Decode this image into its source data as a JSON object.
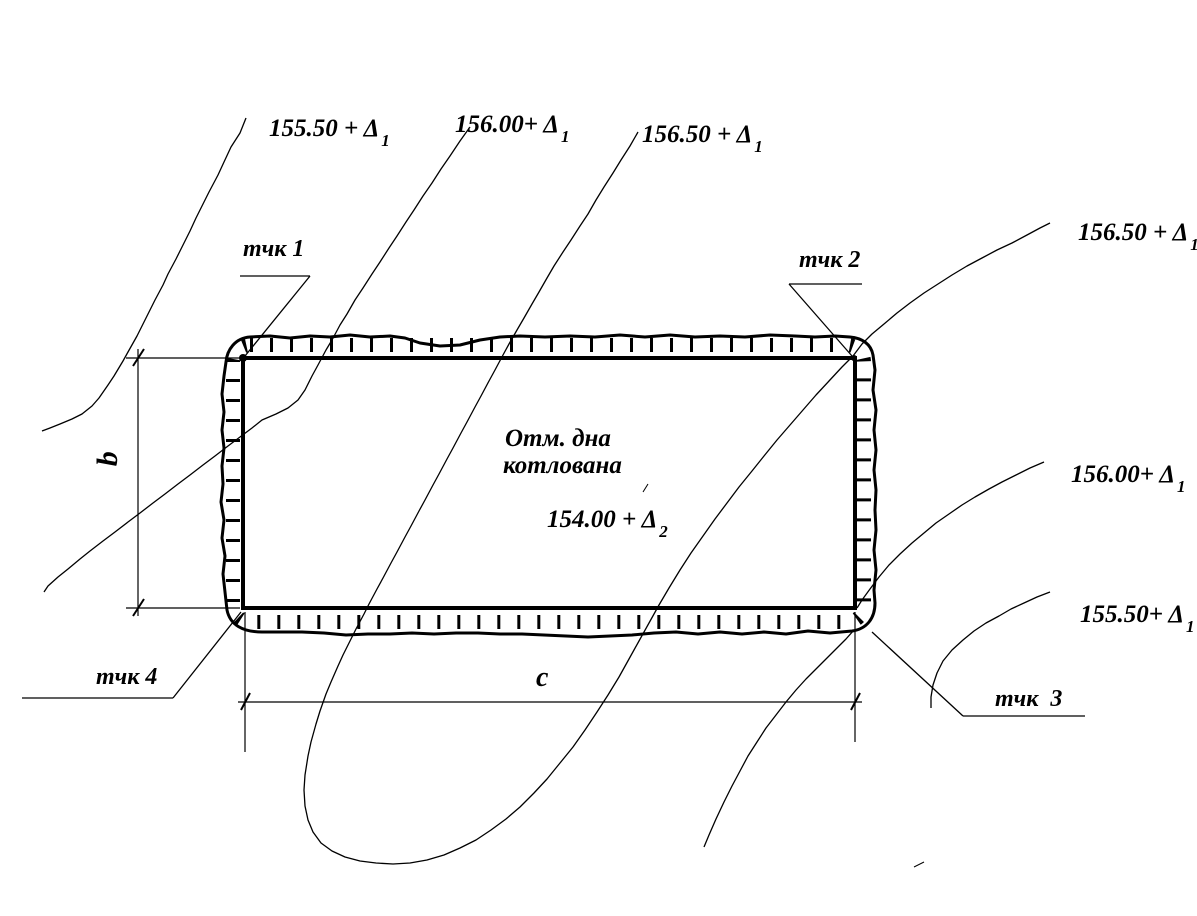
{
  "drawing": {
    "background": "#ffffff",
    "ink": "#000000",
    "contour_labels": {
      "top": [
        {
          "text": "155.50 + Δ",
          "sub": "1"
        },
        {
          "text": "156.00+ Δ",
          "sub": "1"
        },
        {
          "text": "156.50 + Δ",
          "sub": "1"
        }
      ],
      "right": [
        {
          "text": "156.50 + Δ",
          "sub": "1"
        },
        {
          "text": "156.00+ Δ",
          "sub": "1"
        },
        {
          "text": "155.50+ Δ",
          "sub": "1"
        }
      ]
    },
    "corner_points": [
      {
        "label": "тчк 1"
      },
      {
        "label": "тчк 2"
      },
      {
        "label": "тчк  3"
      },
      {
        "label": "тчк 4"
      }
    ],
    "pit_bottom_note": {
      "line1": "Отм. дна",
      "line2": "котлована",
      "elevation": "154.00 + Δ",
      "elevation_sub": "2"
    },
    "dimension_labels": {
      "horizontal": "c",
      "vertical": "b"
    }
  }
}
